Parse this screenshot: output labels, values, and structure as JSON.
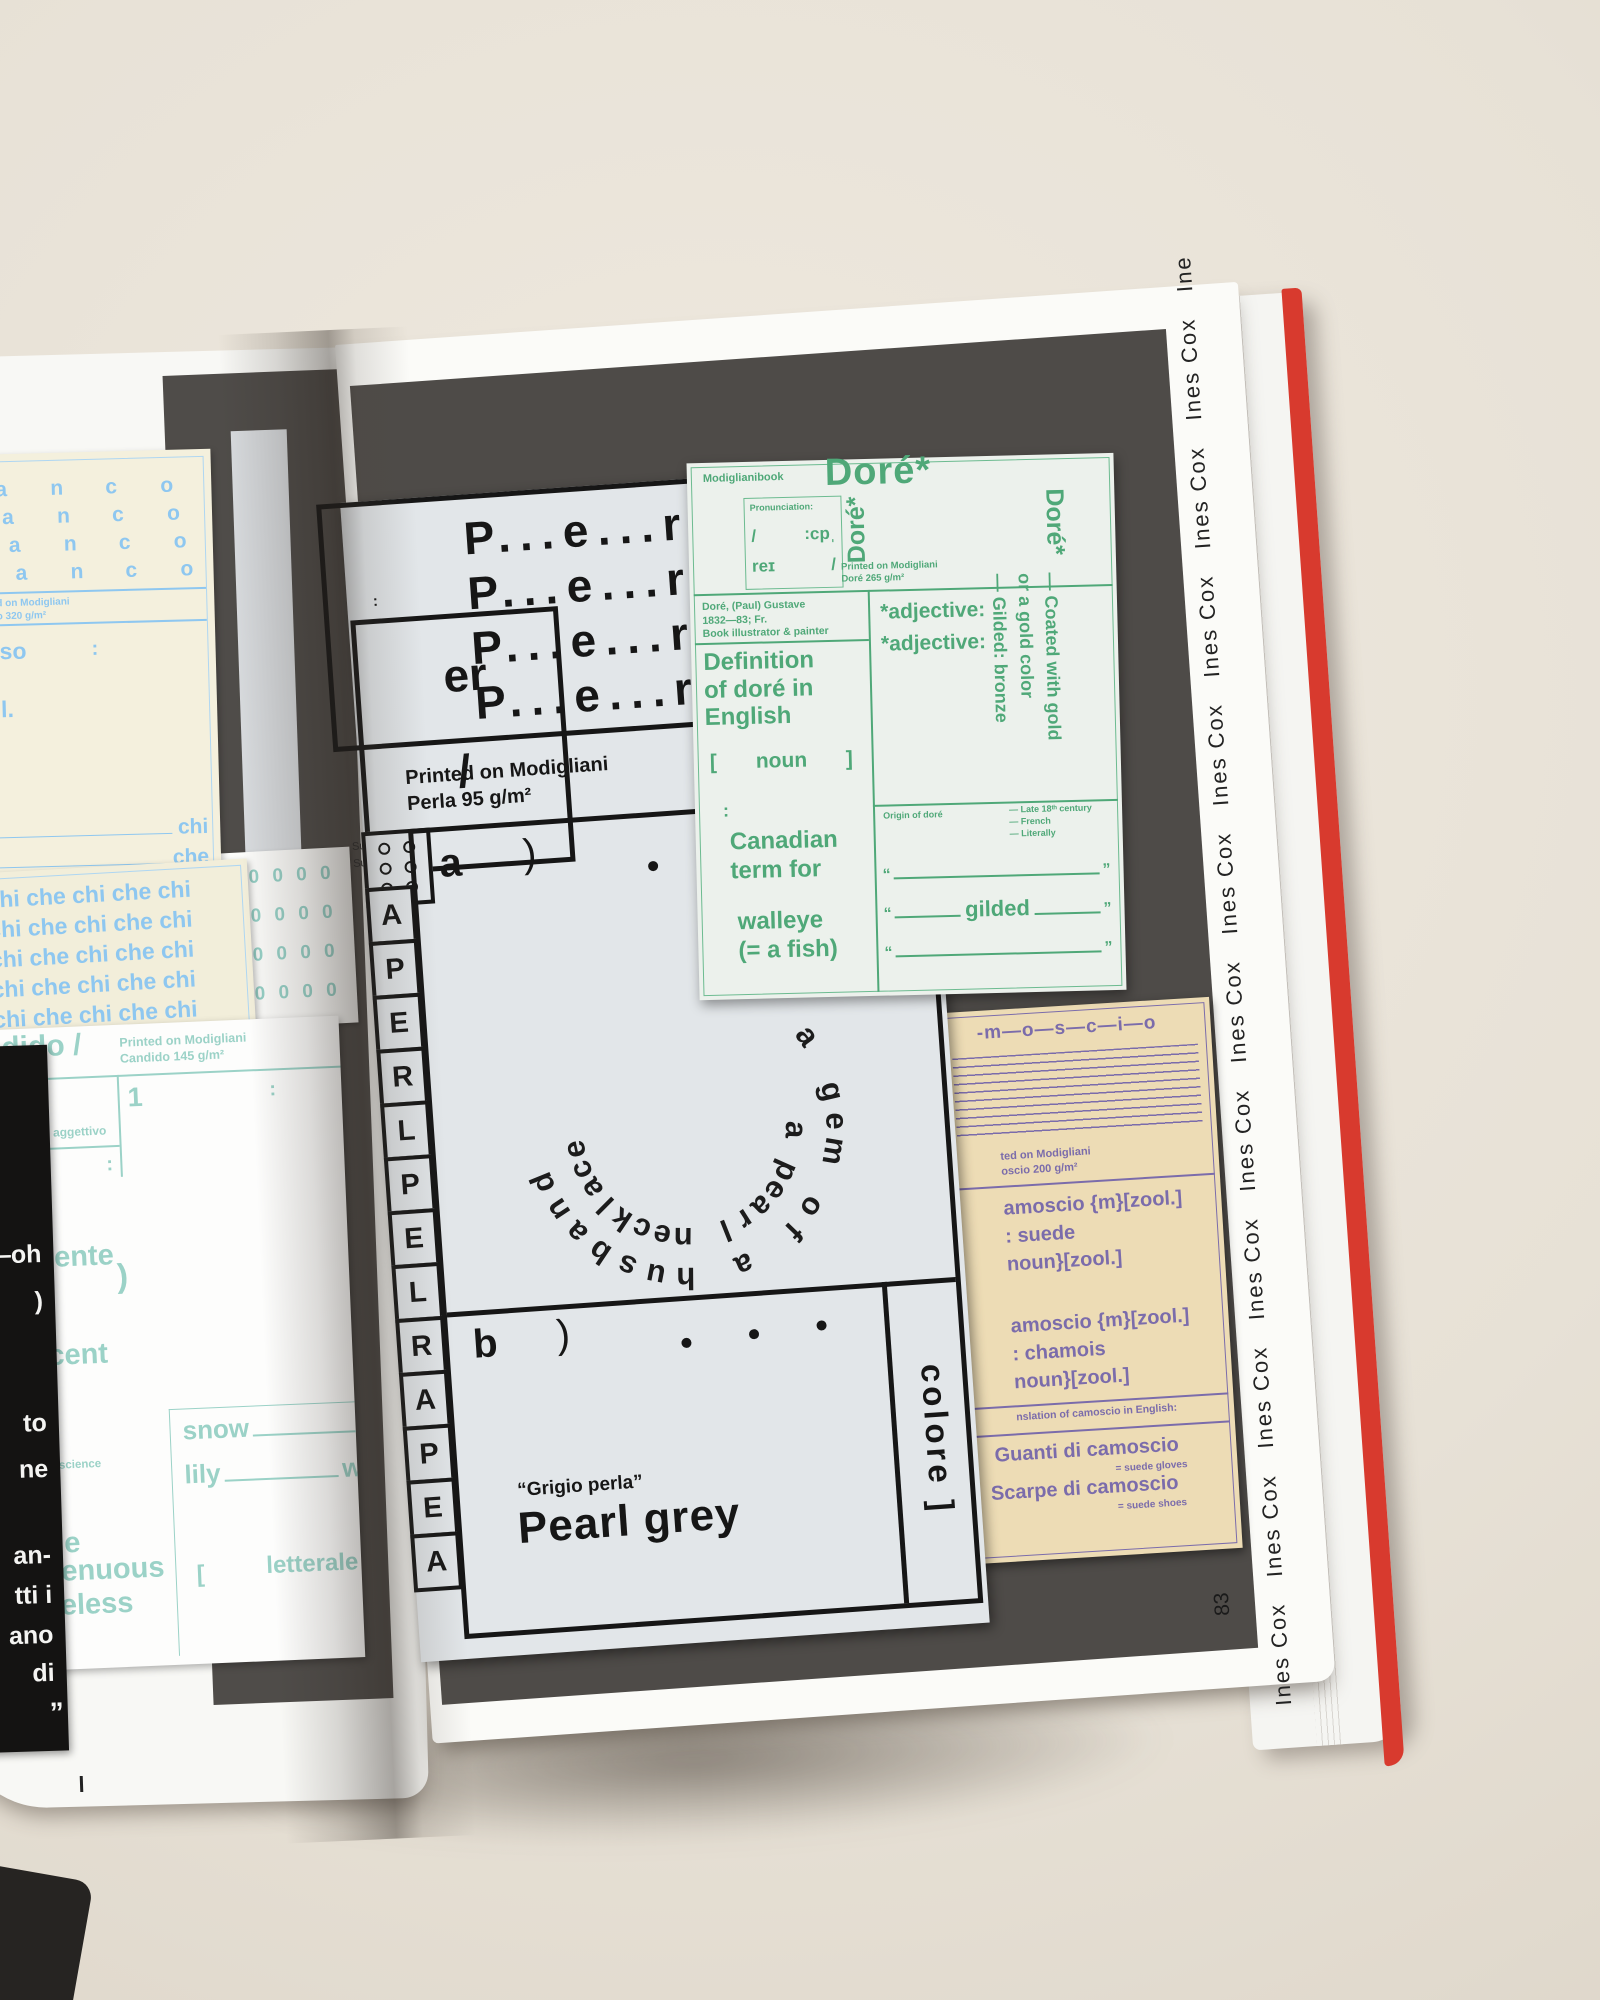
{
  "photo": {
    "page_number": "83",
    "edge_text": "Ines Cox"
  },
  "left_page": {
    "bianco_card": {
      "letters": [
        "a",
        "n",
        "c",
        "o"
      ],
      "rows": 4,
      "printed_frag_line1": "d on Modigliani",
      "printed_frag_line2": "o 320 g/m²",
      "word_frag": "so",
      "colon": ":",
      "l_frag": "l.",
      "rule_label_1": "chi",
      "rule_label_2": "che"
    },
    "chiche_card": {
      "row_text": "chi che chi che chi",
      "rows": 5
    },
    "zeros_card": {
      "row_text": "0 0 0 0 0",
      "rows": 4
    },
    "candido_card": {
      "header_frag": "dido /",
      "printed_on": "Printed on Modigliani",
      "stock": "Candido 145 g/m²",
      "label": "aggettivo",
      "number": "1",
      "colon": ":",
      "frag_ocente": "ocente",
      "frag_ro": "ro",
      "frag_paren": ")",
      "frag_cent": "cent",
      "frag_e1": "e",
      "frag_a": "a",
      "frag_onscience": "onscience",
      "frag_e2": "e",
      "frag_enuous": "enuous",
      "frag_eless": "eless",
      "snow": "snow",
      "lily": "lily",
      "frag_w": "w",
      "bracket": "[",
      "letterale": "letterale"
    },
    "black_card": {
      "fragments": [
        "eer—oh",
        ")",
        "to",
        "ne",
        "an-",
        "tti i",
        "ano",
        "di",
        "”"
      ]
    }
  },
  "right_page": {
    "perla_card": {
      "word_line": "P...e...r...",
      "word_lines": 4,
      "er": "er",
      "slash": "/",
      "colon": ":",
      "printed_on": "Printed on Modigliani",
      "stock": "Perla 95 g/m²",
      "margin_frag_1": "Sustanti",
      "margin_frag_2": "Sustanti",
      "strip_letters": "APERLPELRAPEA",
      "a_label": "a",
      "b_label": "b",
      "paren": ")",
      "circle_outer": "a gem of a husband",
      "circle_inner": "a pearl necklace",
      "quote_frag_left": "“Un",
      "quote_frag_right": "erle”",
      "colore_vertical": "colore ]",
      "grigio_quote": "“Grigio perla”",
      "color_name": "Pearl grey"
    },
    "dore_card": {
      "brand": "Modiglianibook",
      "title": "Doré*",
      "pron_label": "Pronunciation:",
      "ipa_open": "/",
      "ipa_flipped": "ˈdɔ:",
      "ipa_tail": "reɪ",
      "ipa_close": "/",
      "vertical_title": "Doré*",
      "printed_on": "Printed on Modigliani",
      "stock": "Doré 265 g/m²",
      "bio_line1": "Doré, (Paul) Gustave",
      "bio_line2": "1832—83; Fr.",
      "bio_line3": "Book illustrator & painter",
      "definition_l1": "Definition",
      "definition_l2": "of doré in",
      "definition_l3": "English",
      "bracket_open": "[",
      "noun": "noun",
      "bracket_close": "]",
      "colon": ":",
      "term_l1": "Canadian",
      "term_l2": "term for",
      "term_l3": "walleye",
      "term_l4": "(= a fish)",
      "adjective_label": "*adjective:",
      "coated_l1": "— Coated with gold",
      "coated_l2": "or a gold color",
      "coated_l3": "— Gilded: bronze",
      "origin_label": "Origin of doré",
      "origin_note_1": "— Late 18ᵗʰ century",
      "origin_note_2": "— French",
      "origin_note_3": "— Literally",
      "quote_open": "“",
      "quote_close": "”",
      "gilded": "gilded"
    },
    "camoscio_card": {
      "header": "-m—o—s—c—i—o",
      "printed_frag_1": "ted on Modigliani",
      "printed_frag_2": "oscio 200 g/m²",
      "entry1_l1": "amoscio {m}[zool.]",
      "entry1_l2": ": suede",
      "entry1_l3": "noun}[zool.]",
      "entry2_l1": "amoscio {m}[zool.]",
      "entry2_l2": ": chamois",
      "entry2_l3": "noun}[zool.]",
      "translation_frag": "nslation of camoscio in English:",
      "example1_it": "Guanti di camoscio",
      "example1_en": "= suede gloves",
      "example2_it": "Scarpe di camoscio",
      "example2_en": "= suede shoes"
    }
  },
  "colors": {
    "accent_green": "#4fa878",
    "accent_blue": "#8ec7f0",
    "accent_teal": "#9bd2c7",
    "accent_purple": "#7b6cab",
    "cover_red": "#d83a2e",
    "print_grey": "#4e4b48",
    "perla_bg": "#e2e6e9",
    "tan_bg": "#eddcb5",
    "cream_bg": "#f4f0dd"
  }
}
